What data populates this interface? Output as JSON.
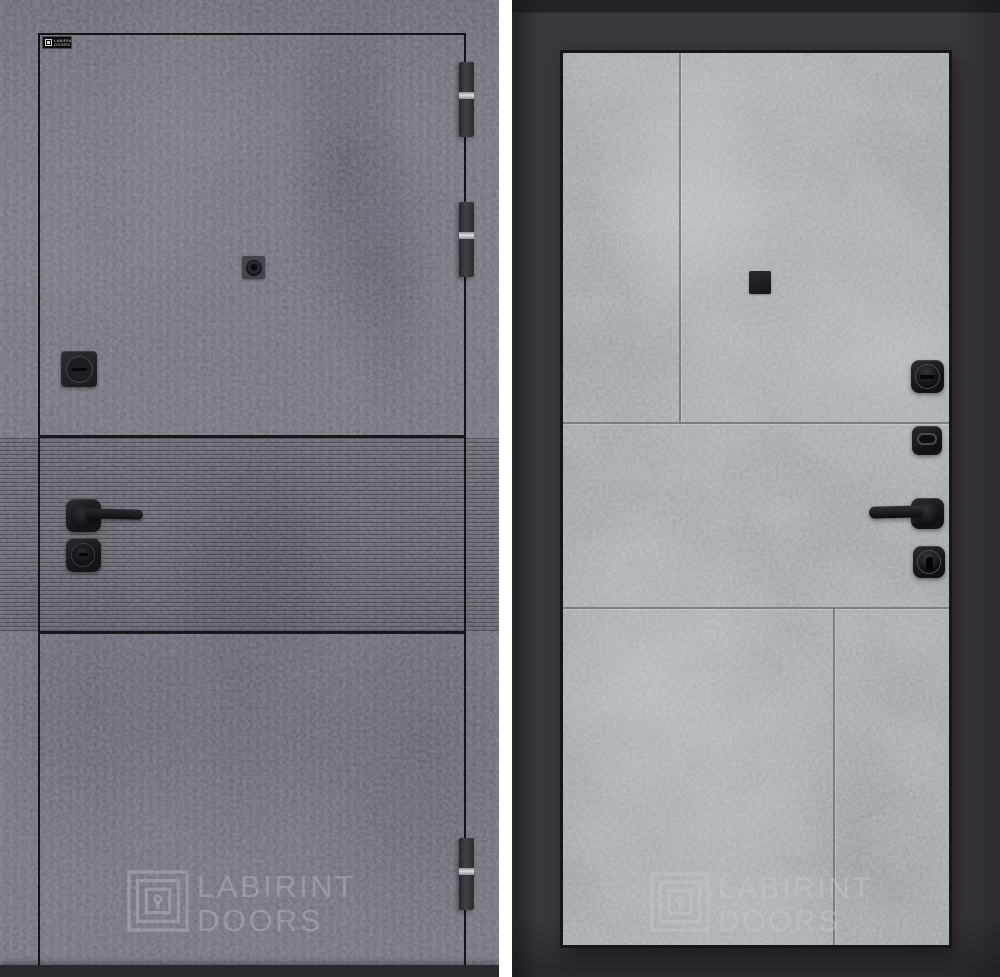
{
  "brand_badge": {
    "line1": "LABIRINT",
    "line2": "DOORS"
  },
  "left_panel": {
    "finish": "dark concrete",
    "watermark_line1": "LABIRINT",
    "watermark_line2": "DOORS"
  },
  "right_panel": {
    "finish": "light concrete",
    "watermark_line1": "LABIRINT",
    "watermark_line2": "DOORS"
  },
  "colors": {
    "left_concrete": "#76757D",
    "left_fluted_band": "#6D6C74",
    "right_concrete": "#A6AAAE",
    "frame_dark": "#3A363D",
    "divider": "#FFFFFF",
    "hardware_black": "#1B1A1E",
    "hinge_chrome": "#DDDDE2",
    "watermark_left": "rgba(206,206,215,0.34)",
    "watermark_right": "rgba(196,200,204,0.50)"
  }
}
